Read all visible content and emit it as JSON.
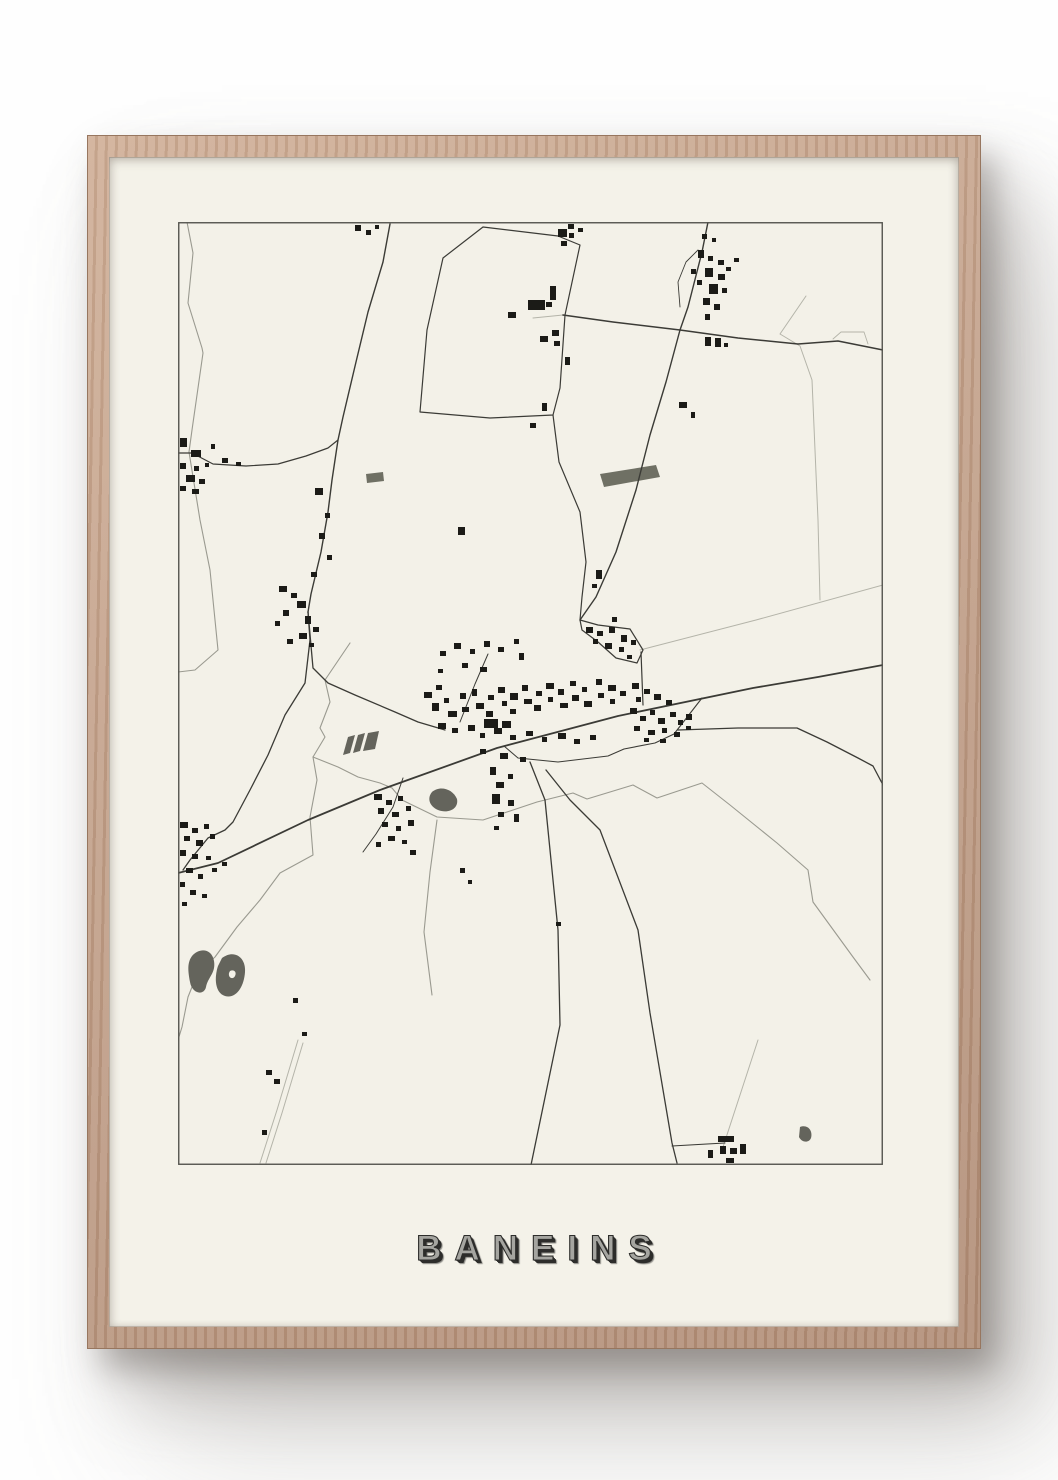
{
  "poster": {
    "title": "BANEINS"
  },
  "colors": {
    "page_bg": "#fefefe",
    "frame_wood": "#c2a089",
    "mat": "#f4f2e9",
    "map_bg": "#f3f1e8",
    "map_border": "#55554f",
    "road_dark": "#3b3b36",
    "road_light": "#b4b4a9",
    "river": "#9a9a90",
    "building": "#1b1b17",
    "pond": "#64645c",
    "field": "#6f7064",
    "title_fill": "#a5a5a0",
    "title_shadow": "#2d2d2b"
  },
  "map": {
    "width": 705,
    "height": 943,
    "roads_dark": [
      {
        "w": 1.8,
        "p": "705,443 640,455 575,466 440,494 319,526 202,568 130,598 40,641 0,651"
      },
      {
        "w": 1.4,
        "p": "212,2 205,40 190,90 178,140 165,195 160,218 154,258 150,290 143,330 133,372 130,390"
      },
      {
        "w": 1.2,
        "p": "0,231 14,231 35,242 68,244 100,242 128,234 150,226 160,218"
      },
      {
        "w": 1.3,
        "p": "130,390 135,446 150,461 177,473 217,490 240,500 267,508"
      },
      {
        "w": 1.3,
        "p": "130,390 132,418 127,461 107,493 90,533 72,568 55,600 47,608 30,616 12,638 5,648"
      },
      {
        "w": 1.2,
        "p": "305,5 265,36 249,108 242,190 312,196 375,193 382,166 387,93 402,23 380,14 305,5"
      },
      {
        "w": 1.2,
        "p": "375,193 381,240 402,290 408,340 404,375 402,398"
      },
      {
        "w": 1.5,
        "p": "385,93 435,100 502,108 560,116 620,122 660,119 700,127 705,128"
      },
      {
        "w": 1.4,
        "p": "530,0 524,30 510,85 502,108 488,160 472,213 458,268 438,330 418,375 402,398"
      },
      {
        "w": 1.2,
        "p": "402,398 420,403 452,407 465,428 459,441 438,436 420,420 404,408 402,398"
      },
      {
        "w": 1.2,
        "p": "463,430 465,483"
      },
      {
        "w": 1.1,
        "p": "446,527 477,521 496,512 524,476"
      },
      {
        "w": 1.0,
        "p": "446,527 430,534 380,540 340,536 326,524"
      },
      {
        "w": 1.3,
        "p": "500,508 560,506 619,506 649,520 680,536 695,544 705,563"
      },
      {
        "w": 1.3,
        "p": "352,540 367,578 380,708 382,803 353,943"
      },
      {
        "w": 1.3,
        "p": "368,548 392,578 422,608 460,708 472,791 494,921 499,941"
      },
      {
        "w": 1.1,
        "p": "494,924 547,921"
      },
      {
        "w": 1.0,
        "p": "282,500 297,462 310,432"
      },
      {
        "w": 1.0,
        "p": "225,556 215,585 198,612 185,630"
      },
      {
        "w": 0.9,
        "p": "520,28 508,40 500,60 502,85"
      }
    ],
    "roads_light": [
      {
        "w": 1.0,
        "p": "462,428 578,398 705,363"
      },
      {
        "w": 1.0,
        "p": "628,74 602,112 622,124 634,158 640,298 642,378"
      },
      {
        "w": 1.0,
        "p": "120,818 99,888 82,941"
      },
      {
        "w": 1.0,
        "p": "125,821 104,891 88,941"
      },
      {
        "w": 1.0,
        "p": "580,818 545,925"
      },
      {
        "w": 0.9,
        "p": "655,117 663,110 686,110 690,122"
      },
      {
        "w": 1.0,
        "p": "355,96 385,93"
      }
    ],
    "rivers": [
      {
        "p": "9,0 15,31 10,81 24,126 25,131 14,208 11,230"
      },
      {
        "p": "11,230 22,298 32,348 40,428 17,448 0,450"
      },
      {
        "p": "172,421 147,458 152,480 142,506 147,515 135,535 139,558 132,595 135,633 102,651 82,678 59,705 37,735 20,750 10,775 4,805 0,818"
      },
      {
        "p": "135,535 160,545 180,555 202,561 214,566 224,578 259,595 305,598 359,580 395,571 409,577 455,563 479,576 524,561 552,583 599,621 630,648 635,680 675,735 692,758"
      },
      {
        "p": "259,598 252,650 246,710 254,773"
      }
    ],
    "water_shapes": [
      {
        "d": "M 14,734 C 22,725 34,727 36,739 C 38,751 30,755 28,765 C 26,774 14,772 12,760 C 10,749 9,741 14,734 Z",
        "fill": "pond"
      },
      {
        "d": "M 44,736 C 56,727 68,735 67,750 C 66,765 58,777 47,774 C 37,771 36,756 40,744 Z",
        "fill": "pond"
      },
      {
        "d": "M 52,749 C 56,747 59,750 57,754 C 55,758 50,756 51,751 Z",
        "fill": "mat"
      },
      {
        "d": "M 254,570 C 262,563 275,567 279,577 C 281,587 270,592 260,588 C 251,584 249,576 254,570 Z",
        "fill": "pond"
      },
      {
        "d": "M 622,905 C 630,902 635,909 633,916 C 631,921 624,921 621,915 Z",
        "fill": "pond"
      },
      {
        "d": "M 422,252 L 478,243 L 482,255 L 426,265 Z",
        "fill": "field"
      },
      {
        "d": "M 188,252 L 205,250 L 206,259 L 189,261 Z",
        "fill": "field"
      },
      {
        "d": "M 170,515 L 177,513 L 172,531 L 165,533 Z",
        "fill": "pond"
      },
      {
        "d": "M 180,513 L 187,511 L 182,529 L 175,531 Z",
        "fill": "pond"
      },
      {
        "d": "M 190,511 L 201,509 L 197,527 L 185,529 Z",
        "fill": "pond"
      }
    ],
    "buildings": [
      [
        2,
        216,
        7,
        9
      ],
      [
        13,
        228,
        10,
        7
      ],
      [
        2,
        241,
        6,
        6
      ],
      [
        16,
        244,
        5,
        5
      ],
      [
        8,
        253,
        9,
        7
      ],
      [
        21,
        257,
        6,
        5
      ],
      [
        2,
        264,
        6,
        5
      ],
      [
        14,
        267,
        7,
        5
      ],
      [
        27,
        241,
        4,
        4
      ],
      [
        33,
        222,
        4,
        5
      ],
      [
        44,
        236,
        6,
        5
      ],
      [
        58,
        240,
        5,
        4
      ],
      [
        177,
        3,
        6,
        6
      ],
      [
        188,
        8,
        5,
        5
      ],
      [
        197,
        3,
        4,
        4
      ],
      [
        390,
        2,
        6,
        5
      ],
      [
        400,
        6,
        5,
        4
      ],
      [
        101,
        364,
        8,
        6
      ],
      [
        113,
        371,
        6,
        5
      ],
      [
        119,
        379,
        9,
        7
      ],
      [
        105,
        388,
        6,
        6
      ],
      [
        127,
        394,
        6,
        8
      ],
      [
        97,
        399,
        5,
        5
      ],
      [
        135,
        405,
        6,
        5
      ],
      [
        121,
        411,
        8,
        6
      ],
      [
        109,
        417,
        6,
        5
      ],
      [
        131,
        421,
        5,
        4
      ],
      [
        137,
        266,
        8,
        7
      ],
      [
        147,
        291,
        5,
        5
      ],
      [
        141,
        311,
        6,
        6
      ],
      [
        149,
        333,
        5,
        5
      ],
      [
        133,
        350,
        6,
        5
      ],
      [
        246,
        470,
        8,
        6
      ],
      [
        258,
        463,
        6,
        5
      ],
      [
        254,
        481,
        7,
        8
      ],
      [
        266,
        476,
        5,
        5
      ],
      [
        270,
        489,
        9,
        6
      ],
      [
        282,
        471,
        6,
        6
      ],
      [
        284,
        485,
        7,
        5
      ],
      [
        294,
        467,
        5,
        7
      ],
      [
        298,
        481,
        8,
        6
      ],
      [
        310,
        473,
        6,
        5
      ],
      [
        308,
        489,
        7,
        6
      ],
      [
        320,
        465,
        7,
        6
      ],
      [
        324,
        479,
        5,
        5
      ],
      [
        332,
        471,
        8,
        7
      ],
      [
        332,
        487,
        6,
        5
      ],
      [
        344,
        463,
        6,
        6
      ],
      [
        346,
        477,
        8,
        5
      ],
      [
        358,
        469,
        6,
        5
      ],
      [
        356,
        483,
        7,
        6
      ],
      [
        368,
        461,
        8,
        6
      ],
      [
        370,
        475,
        5,
        5
      ],
      [
        380,
        467,
        6,
        6
      ],
      [
        382,
        481,
        8,
        5
      ],
      [
        392,
        459,
        6,
        5
      ],
      [
        394,
        473,
        7,
        6
      ],
      [
        404,
        465,
        5,
        5
      ],
      [
        406,
        479,
        8,
        6
      ],
      [
        418,
        457,
        6,
        6
      ],
      [
        420,
        471,
        6,
        5
      ],
      [
        430,
        463,
        8,
        6
      ],
      [
        432,
        477,
        5,
        5
      ],
      [
        442,
        469,
        6,
        5
      ],
      [
        454,
        461,
        7,
        6
      ],
      [
        458,
        475,
        5,
        5
      ],
      [
        466,
        467,
        6,
        5
      ],
      [
        476,
        472,
        7,
        6
      ],
      [
        488,
        478,
        6,
        5
      ],
      [
        306,
        497,
        14,
        9
      ],
      [
        324,
        499,
        9,
        7
      ],
      [
        260,
        501,
        8,
        6
      ],
      [
        274,
        506,
        6,
        5
      ],
      [
        290,
        503,
        7,
        6
      ],
      [
        302,
        511,
        5,
        5
      ],
      [
        316,
        506,
        8,
        6
      ],
      [
        332,
        513,
        6,
        5
      ],
      [
        348,
        509,
        7,
        5
      ],
      [
        364,
        515,
        5,
        5
      ],
      [
        380,
        511,
        8,
        6
      ],
      [
        396,
        517,
        6,
        5
      ],
      [
        412,
        513,
        6,
        5
      ],
      [
        302,
        527,
        6,
        5
      ],
      [
        322,
        531,
        8,
        6
      ],
      [
        342,
        535,
        6,
        5
      ],
      [
        314,
        572,
        8,
        10
      ],
      [
        330,
        578,
        6,
        6
      ],
      [
        320,
        590,
        6,
        5
      ],
      [
        336,
        592,
        5,
        8
      ],
      [
        316,
        604,
        5,
        4
      ],
      [
        312,
        545,
        6,
        8
      ],
      [
        330,
        552,
        5,
        5
      ],
      [
        318,
        560,
        8,
        6
      ],
      [
        452,
        486,
        7,
        6
      ],
      [
        462,
        494,
        6,
        5
      ],
      [
        472,
        488,
        5,
        5
      ],
      [
        480,
        496,
        7,
        6
      ],
      [
        492,
        490,
        6,
        5
      ],
      [
        500,
        498,
        5,
        5
      ],
      [
        508,
        492,
        6,
        6
      ],
      [
        456,
        504,
        6,
        5
      ],
      [
        470,
        508,
        7,
        5
      ],
      [
        484,
        506,
        5,
        5
      ],
      [
        496,
        510,
        6,
        5
      ],
      [
        508,
        504,
        5,
        4
      ],
      [
        466,
        516,
        5,
        4
      ],
      [
        482,
        517,
        6,
        4
      ],
      [
        408,
        405,
        7,
        6
      ],
      [
        419,
        409,
        6,
        5
      ],
      [
        431,
        405,
        6,
        6
      ],
      [
        443,
        413,
        6,
        7
      ],
      [
        427,
        421,
        7,
        6
      ],
      [
        441,
        425,
        5,
        5
      ],
      [
        415,
        417,
        5,
        5
      ],
      [
        449,
        433,
        5,
        4
      ],
      [
        434,
        395,
        5,
        5
      ],
      [
        453,
        418,
        5,
        5
      ],
      [
        262,
        429,
        6,
        5
      ],
      [
        276,
        421,
        7,
        6
      ],
      [
        292,
        427,
        5,
        5
      ],
      [
        306,
        419,
        6,
        6
      ],
      [
        320,
        425,
        6,
        5
      ],
      [
        336,
        417,
        5,
        5
      ],
      [
        284,
        441,
        6,
        5
      ],
      [
        302,
        445,
        7,
        5
      ],
      [
        260,
        447,
        5,
        4
      ],
      [
        341,
        431,
        5,
        7
      ],
      [
        418,
        348,
        6,
        9
      ],
      [
        414,
        362,
        5,
        4
      ],
      [
        387,
        135,
        5,
        8
      ],
      [
        364,
        181,
        5,
        8
      ],
      [
        352,
        201,
        6,
        5
      ],
      [
        280,
        305,
        7,
        8
      ],
      [
        380,
        7,
        9,
        8
      ],
      [
        391,
        11,
        5,
        5
      ],
      [
        383,
        19,
        6,
        5
      ],
      [
        350,
        78,
        17,
        10
      ],
      [
        368,
        80,
        6,
        5
      ],
      [
        372,
        64,
        6,
        14
      ],
      [
        330,
        90,
        8,
        6
      ],
      [
        362,
        114,
        8,
        6
      ],
      [
        374,
        108,
        7,
        6
      ],
      [
        376,
        119,
        6,
        5
      ],
      [
        520,
        28,
        6,
        8
      ],
      [
        530,
        34,
        5,
        5
      ],
      [
        540,
        38,
        6,
        5
      ],
      [
        527,
        46,
        8,
        9
      ],
      [
        540,
        52,
        7,
        6
      ],
      [
        519,
        58,
        5,
        5
      ],
      [
        531,
        62,
        9,
        10
      ],
      [
        544,
        66,
        5,
        5
      ],
      [
        525,
        76,
        7,
        7
      ],
      [
        536,
        82,
        6,
        6
      ],
      [
        527,
        92,
        5,
        6
      ],
      [
        548,
        45,
        5,
        4
      ],
      [
        513,
        47,
        5,
        5
      ],
      [
        524,
        12,
        5,
        5
      ],
      [
        534,
        16,
        4,
        4
      ],
      [
        556,
        36,
        5,
        4
      ],
      [
        527,
        115,
        6,
        9
      ],
      [
        537,
        116,
        6,
        9
      ],
      [
        546,
        121,
        4,
        4
      ],
      [
        513,
        190,
        4,
        6
      ],
      [
        501,
        180,
        8,
        6
      ],
      [
        196,
        572,
        8,
        6
      ],
      [
        208,
        578,
        6,
        5
      ],
      [
        220,
        574,
        5,
        5
      ],
      [
        200,
        586,
        6,
        6
      ],
      [
        214,
        590,
        7,
        5
      ],
      [
        228,
        584,
        5,
        5
      ],
      [
        204,
        600,
        6,
        5
      ],
      [
        218,
        604,
        5,
        5
      ],
      [
        230,
        598,
        6,
        6
      ],
      [
        210,
        614,
        7,
        5
      ],
      [
        224,
        618,
        5,
        4
      ],
      [
        198,
        620,
        5,
        5
      ],
      [
        232,
        628,
        6,
        5
      ],
      [
        2,
        600,
        8,
        6
      ],
      [
        14,
        606,
        6,
        5
      ],
      [
        26,
        602,
        5,
        5
      ],
      [
        6,
        614,
        6,
        5
      ],
      [
        18,
        618,
        7,
        6
      ],
      [
        32,
        612,
        5,
        5
      ],
      [
        2,
        628,
        6,
        6
      ],
      [
        14,
        632,
        6,
        5
      ],
      [
        28,
        634,
        5,
        4
      ],
      [
        8,
        646,
        7,
        5
      ],
      [
        20,
        652,
        5,
        5
      ],
      [
        2,
        660,
        5,
        5
      ],
      [
        34,
        646,
        5,
        4
      ],
      [
        44,
        640,
        5,
        4
      ],
      [
        12,
        668,
        6,
        5
      ],
      [
        24,
        672,
        5,
        4
      ],
      [
        4,
        680,
        5,
        4
      ],
      [
        88,
        848,
        6,
        5
      ],
      [
        96,
        857,
        6,
        5
      ],
      [
        84,
        908,
        5,
        5
      ],
      [
        115,
        776,
        5,
        5
      ],
      [
        124,
        810,
        5,
        4
      ],
      [
        282,
        646,
        5,
        5
      ],
      [
        290,
        658,
        4,
        4
      ],
      [
        378,
        700,
        5,
        4
      ],
      [
        540,
        914,
        16,
        6
      ],
      [
        542,
        924,
        6,
        8
      ],
      [
        552,
        926,
        7,
        6
      ],
      [
        562,
        922,
        6,
        10
      ],
      [
        530,
        928,
        5,
        8
      ],
      [
        548,
        936,
        8,
        5
      ]
    ]
  }
}
